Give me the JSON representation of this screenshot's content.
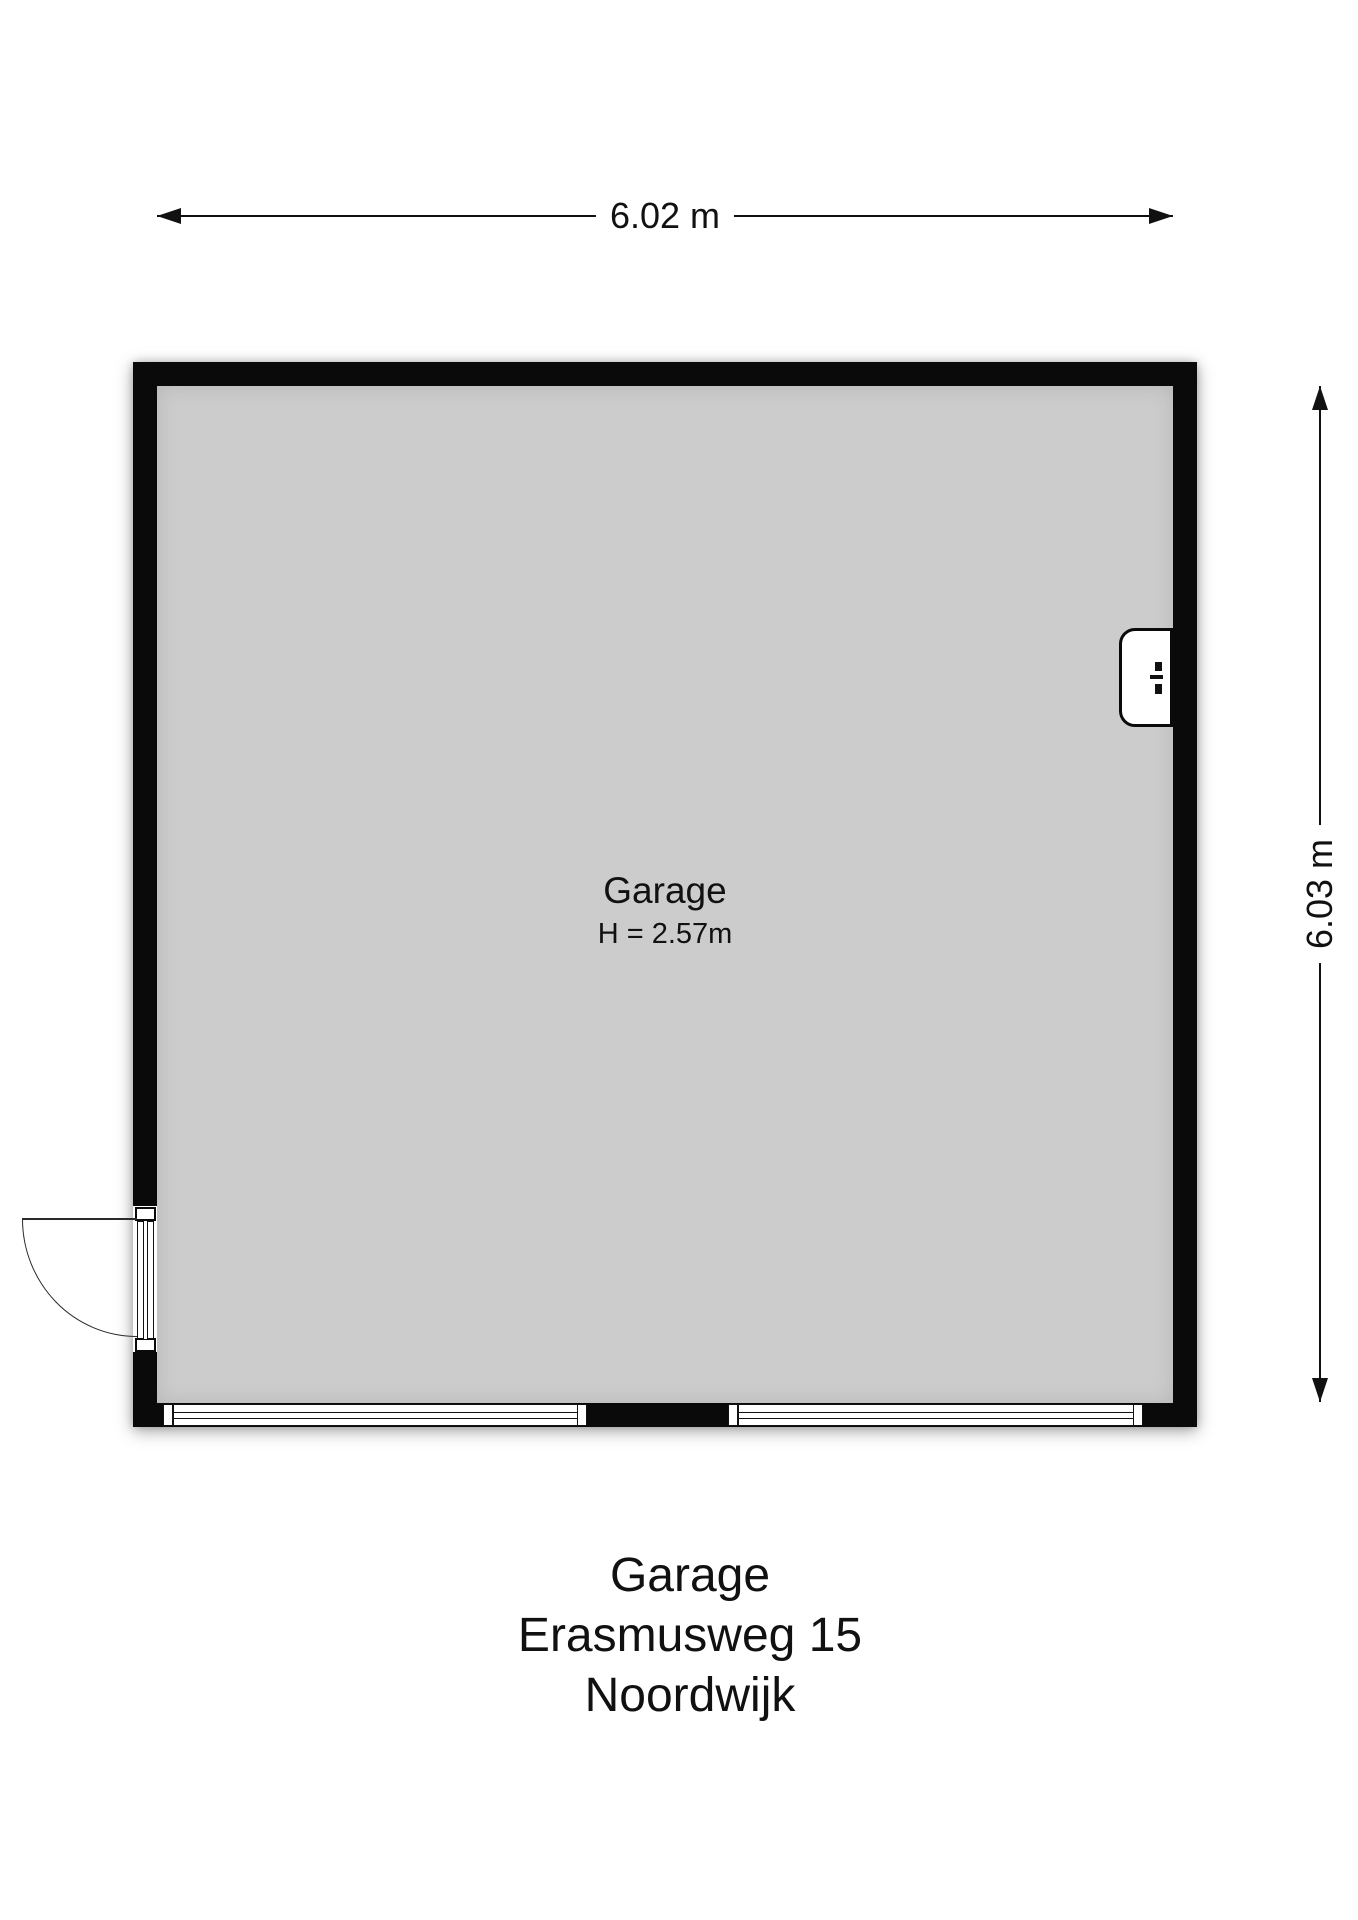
{
  "dimensions": {
    "width_label": "6.02 m",
    "height_label": "6.03 m"
  },
  "room": {
    "name": "Garage",
    "ceiling_height_label": "H = 2.57m"
  },
  "caption": {
    "line1": "Garage",
    "line2": "Erasmusweg 15",
    "line3": "Noordwijk"
  },
  "icons": {
    "door": "door-swing-icon",
    "bottom_wall_left_opening": "window-strip-icon",
    "bottom_wall_right_opening": "window-strip-icon",
    "right_wall_fixture": "meter-box-icon"
  },
  "colors": {
    "wall": "#0a0a0a",
    "floor": "#cccccc",
    "background": "#ffffff",
    "text": "#111111"
  }
}
